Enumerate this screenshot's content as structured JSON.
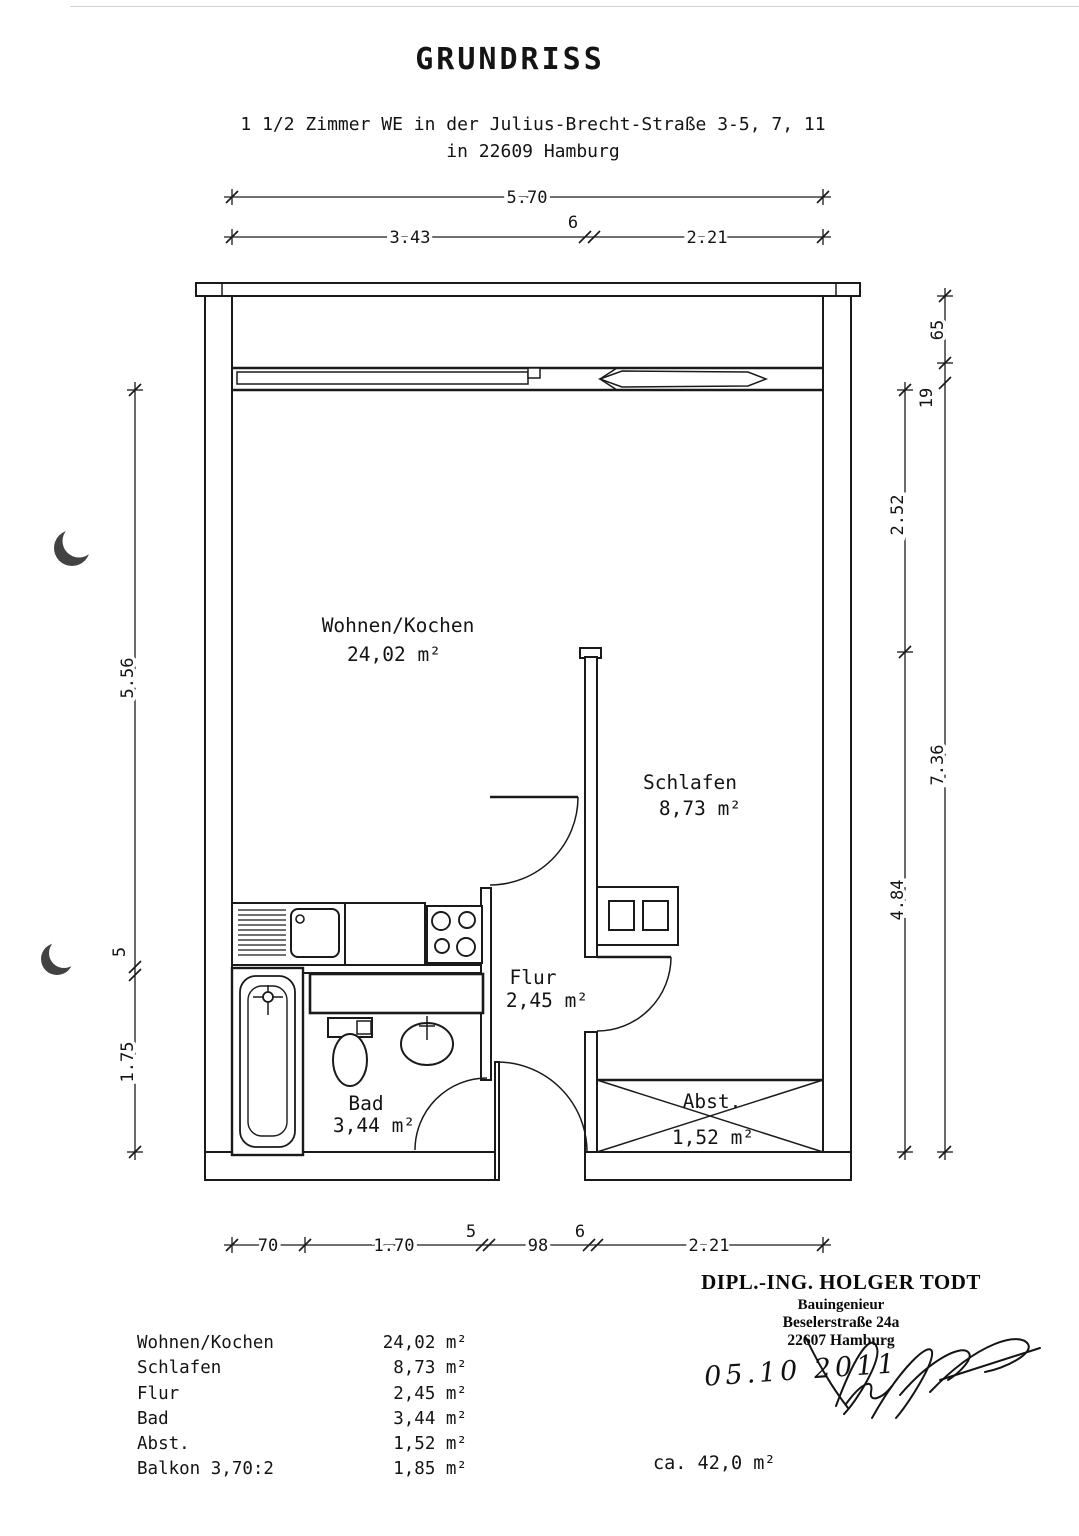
{
  "page": {
    "title": "GRUNDRISS",
    "subtitle_line1": "1 1/2 Zimmer WE in der Julius-Brecht-Straße 3-5, 7, 11",
    "subtitle_line2": "in 22609 Hamburg"
  },
  "plan": {
    "rooms": [
      {
        "name": "Wohnen/Kochen",
        "area": "24,02 m²"
      },
      {
        "name": "Schlafen",
        "area": "8,73 m²"
      },
      {
        "name": "Flur",
        "area": "2,45 m²"
      },
      {
        "name": "Bad",
        "area": "3,44 m²"
      },
      {
        "name": "Abst.",
        "area": "1,52 m²"
      }
    ],
    "dims": {
      "top_total": "5.70",
      "top_left": "3.43",
      "top_mid_wall": "6",
      "top_right": "2.21",
      "left_upper": "5.56",
      "left_wall": "5",
      "left_lower": "1.75",
      "right_inner_upper": "2.52",
      "right_inner_lower": "4.84",
      "right_outer_top": "65",
      "right_outer_wall": "19",
      "right_outer_main": "7.36",
      "bottom_1": "70",
      "bottom_2": "1.70",
      "bottom_3": "5",
      "bottom_4": "98",
      "bottom_5": "6",
      "bottom_6": "2.21"
    }
  },
  "area_table": {
    "rows": [
      {
        "label": "Wohnen/Kochen",
        "value": "24,02 m²"
      },
      {
        "label": "Schlafen",
        "value": "8,73 m²"
      },
      {
        "label": "Flur",
        "value": "2,45 m²"
      },
      {
        "label": "Bad",
        "value": "3,44 m²"
      },
      {
        "label": "Abst.",
        "value": "1,52 m²"
      },
      {
        "label": "Balkon 3,70:2",
        "value": "1,85 m²"
      }
    ],
    "total": "ca. 42,0 m²"
  },
  "stamp": {
    "name": "DIPL.-ING. HOLGER TODT",
    "profession": "Bauingenieur",
    "street": "Beselerstraße 24a",
    "city": "22607 Hamburg",
    "date": "05.10 2011"
  }
}
